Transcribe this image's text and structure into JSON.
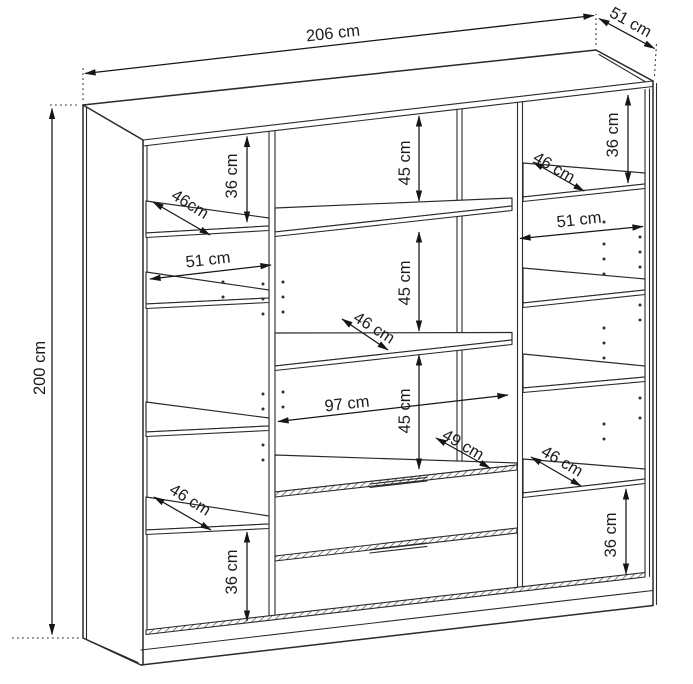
{
  "canvas": {
    "width": 693,
    "height": 684,
    "background": "#ffffff",
    "line_color": "#2a2a2a"
  },
  "dimensions": {
    "overall_width": "206 cm",
    "overall_depth": "51 cm",
    "overall_height": "200 cm",
    "left_column": {
      "top_section_height": "36 cm",
      "upper_shelf_depth": "46cm",
      "column_width": "51 cm",
      "lower_shelf_depth": "46 cm",
      "bottom_section_height": "36 cm"
    },
    "center_column": {
      "upper_gap": "45 cm",
      "middle_gap": "45 cm",
      "lower_gap": "45 cm",
      "shelf_depth": "46 cm",
      "interior_width": "97 cm",
      "top_panel_depth": "49 cm"
    },
    "right_column": {
      "top_section_height": "36 cm",
      "upper_shelf_depth": "46 cm",
      "column_width": "51 cm",
      "lower_shelf_depth": "46 cm",
      "bottom_section_height": "36 cm"
    }
  }
}
